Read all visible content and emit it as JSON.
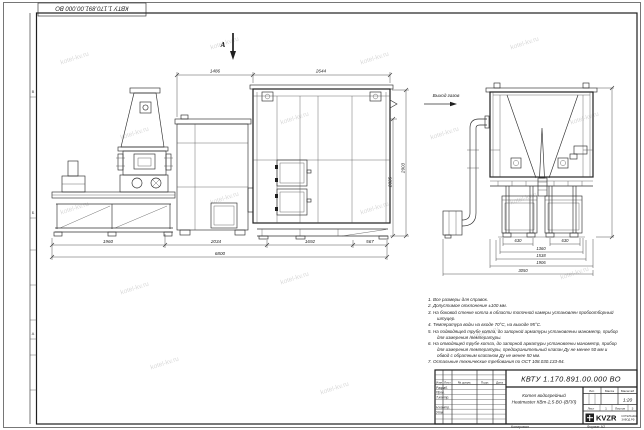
{
  "sheet": {
    "stamp_top_left": "КВТУ 1.170.891.00.000 ВО",
    "copied_label": "Копировал",
    "format_label": "Формат А2",
    "watermark": "kotel-kv.ru",
    "zone_letters": [
      "В",
      "Б",
      "А"
    ]
  },
  "drawing": {
    "view_marker": "А",
    "gas_outlet_label": "Выход газов",
    "side_view": {
      "dim_top": [
        "1486",
        "2644"
      ],
      "dim_bottom": [
        "1960",
        "2034",
        "1692",
        "567"
      ],
      "dim_total": "6800",
      "dim_height_inner": "2335",
      "dim_height_outer": "2903"
    },
    "end_view": {
      "dim_row1": [
        "630",
        "630"
      ],
      "dim_row2": "1360",
      "dim_row3": "1538",
      "dim_row4": "1906",
      "dim_total": "3050"
    }
  },
  "notes": {
    "items": [
      "1.  Все размеры для справок.",
      "2.  Допустимое отклонение ±100 мм.",
      "3.  На боковой стенке котла в области топочной камеры установлен пробоотборный штуцер.",
      "4.  Температура воды на входе 70°С, на выходе 95°С.",
      "5.  На подводящей трубе котла, до запорной арматуры установлены манометр, прибор для измерения температуры.",
      "6.  На отводящей трубе котла, до запорной арматуры установлены манометр, прибор для измерения температуры, предохранительный клапан Ду не менее 50 мм и обвод с обратным клапаном Ду не менее 50 мм.",
      "7.  Остальные технические требования по ОСТ 108.030.133-84."
    ]
  },
  "title_block": {
    "doc_number": "КВТУ 1.170.891.00.000 ВО",
    "product_line1": "Котел водогрейный",
    "product_line2": "Heatmaster КВт-2,5-ВО-(ВПЛ)",
    "col_izm": "Изм",
    "col_list": "Лист",
    "col_doc": "№ докум.",
    "col_sign": "Подп.",
    "col_date": "Дата",
    "row_razrab": "Разраб.",
    "row_prov": "Пров.",
    "row_tkontr": "Т.контр.",
    "row_nkontr": "Н.контр.",
    "row_utv": "Утв.",
    "lit_label": "Лит.",
    "mass_label": "Масса",
    "scale_label": "Масштаб",
    "scale_value": "1:20",
    "sheet_label": "Лист",
    "sheet_value": "1",
    "sheets_label": "Листов",
    "sheets_value": "3",
    "logo_text": "KVZR",
    "logo_sub1": "КОТЕЛЬНЫЙ",
    "logo_sub2": "ЗАВОД.РФ"
  }
}
